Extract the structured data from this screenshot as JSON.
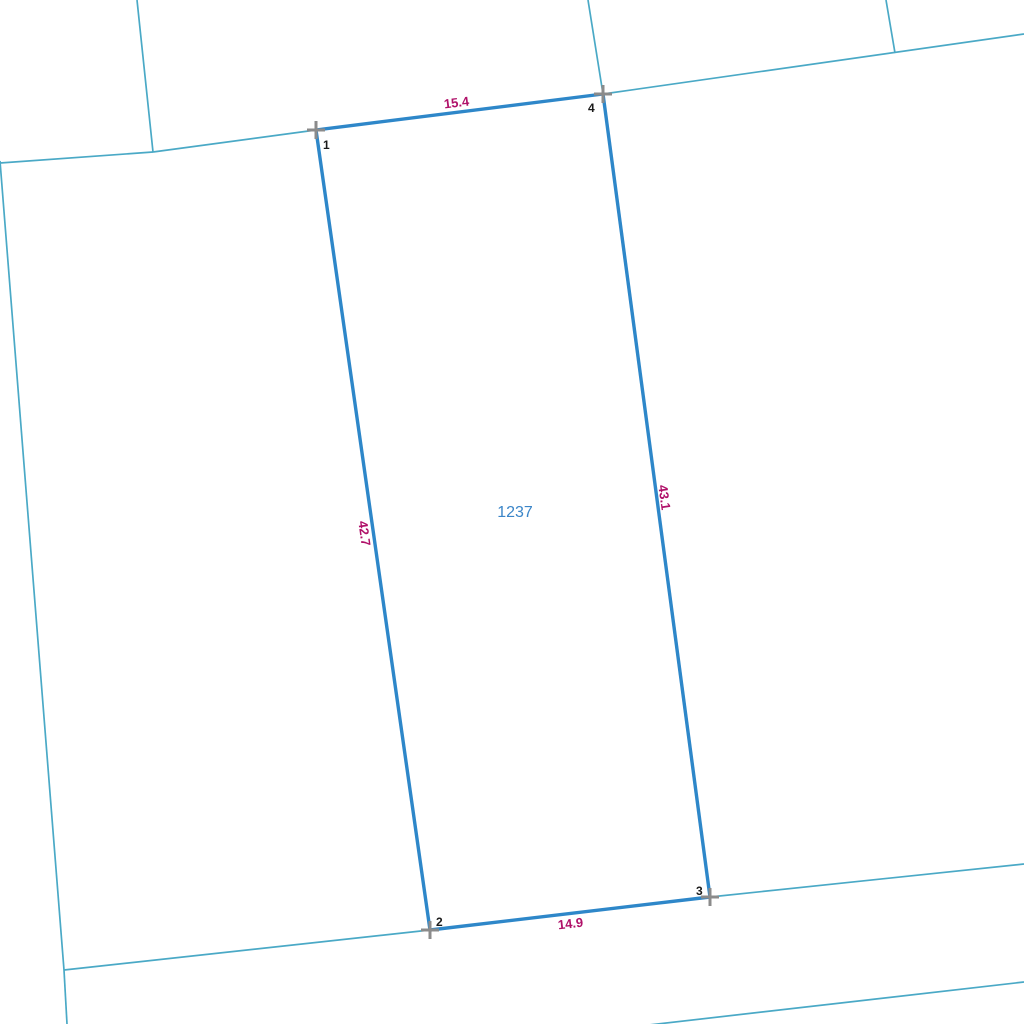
{
  "parcel": {
    "id": "1237",
    "edge_labels": {
      "top": "15.4",
      "right": "43.1",
      "bottom": "14.9",
      "left": "42.7"
    },
    "vertex_labels": {
      "v1": "1",
      "v2": "2",
      "v3": "3",
      "v4": "4"
    }
  },
  "colors": {
    "background": "#ffffff",
    "parcel_boundary": "#2e87c9",
    "neighbor_boundary": "#4aa9c6",
    "dimension_text": "#b01169",
    "parcel_id_text": "#3a85c8",
    "vertex_text": "#1a1a1a",
    "corner_marker": "#8b8b8b"
  }
}
